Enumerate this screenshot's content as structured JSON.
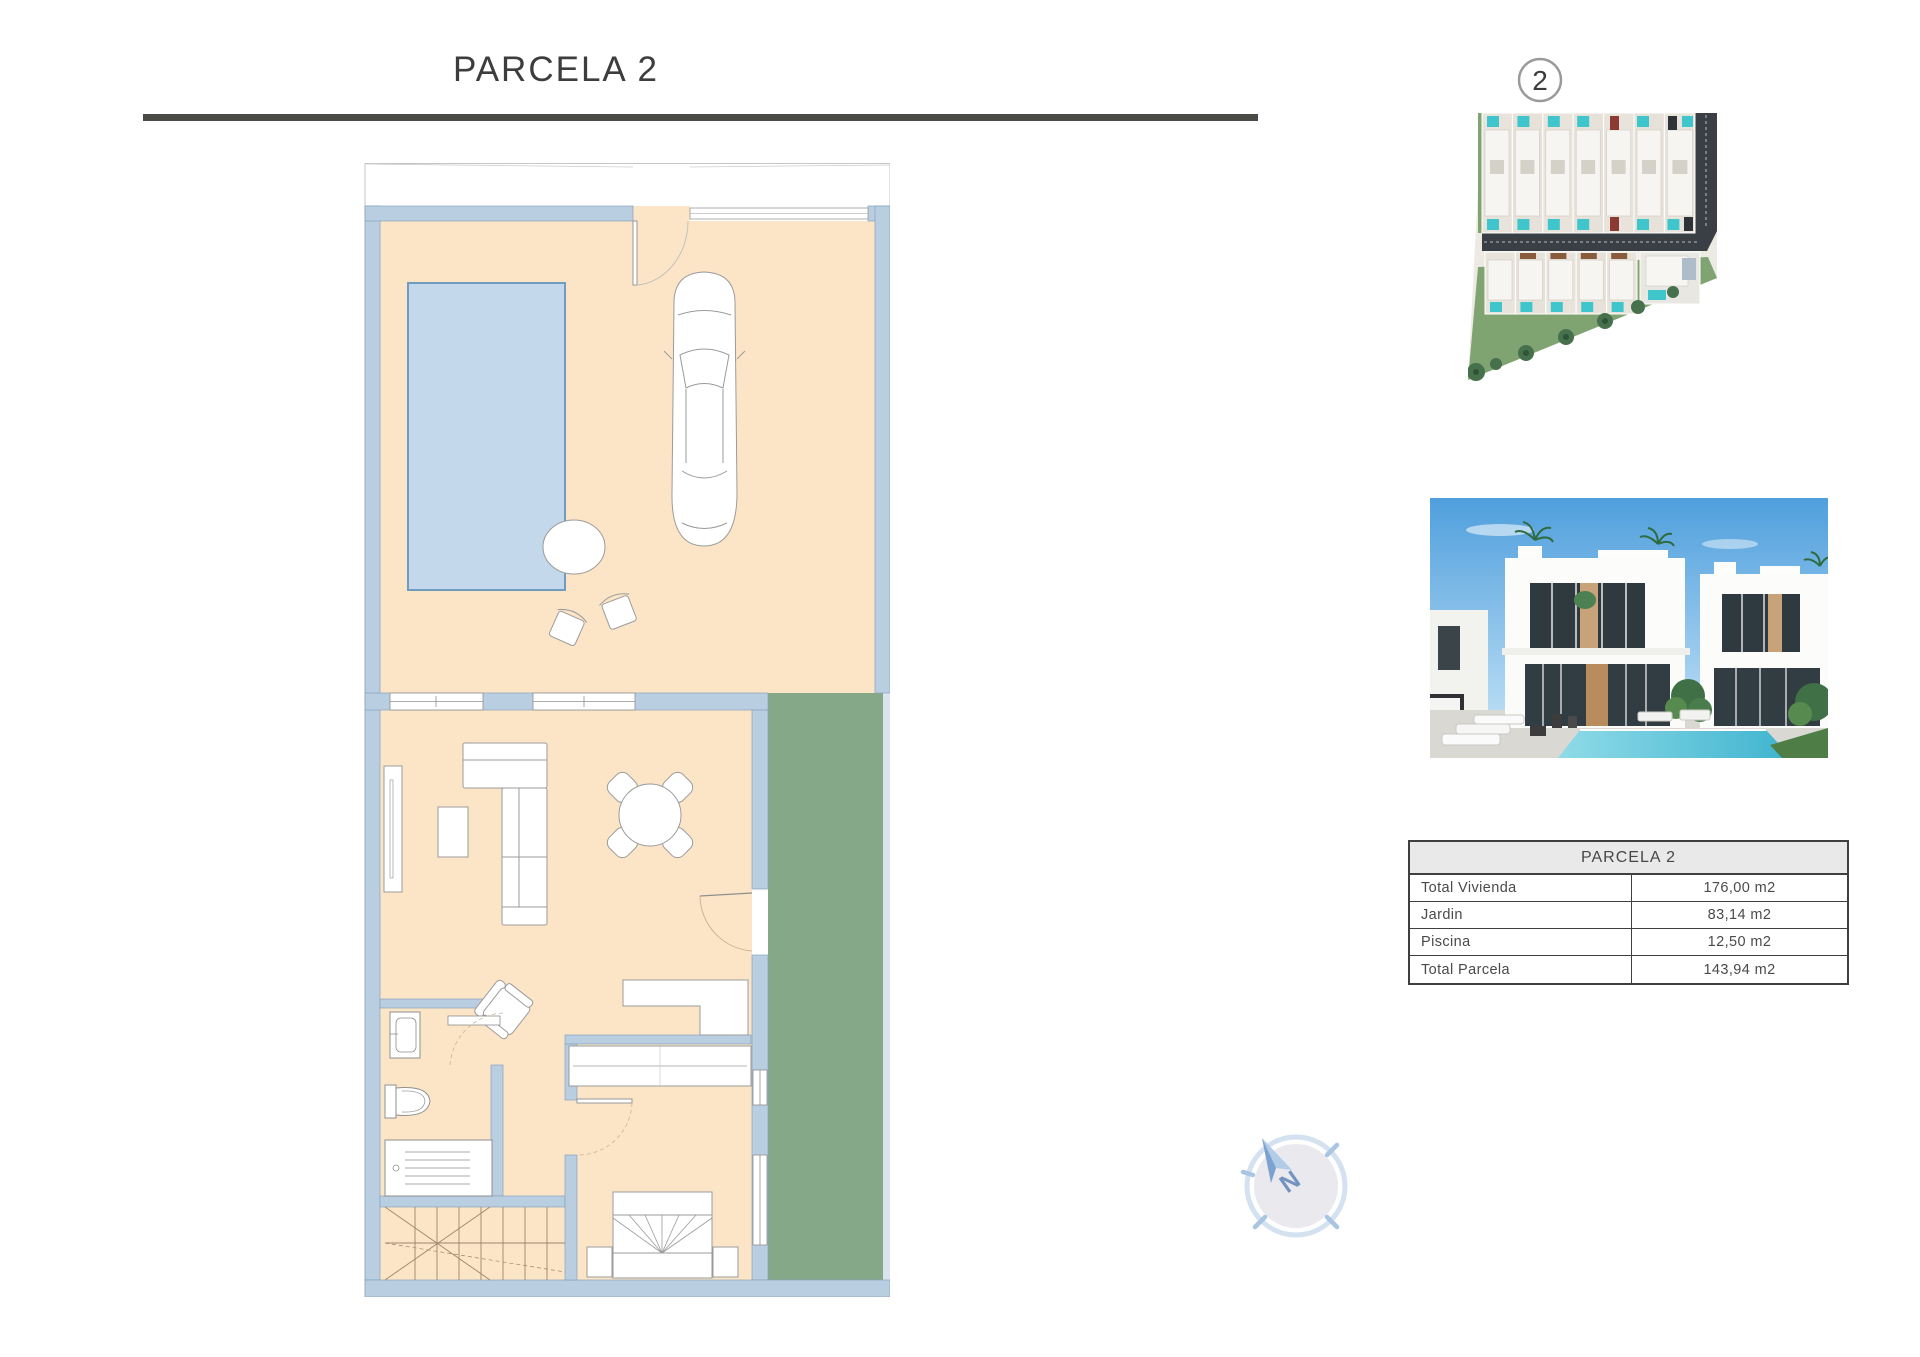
{
  "page": {
    "title": "PARCELA 2"
  },
  "site_plan": {
    "badge": "2"
  },
  "summary_table": {
    "header": "PARCELA 2",
    "rows": [
      {
        "label": "Total Vivienda",
        "value": "176,00 m2"
      },
      {
        "label": "Jardin",
        "value": "83,14 m2"
      },
      {
        "label": "Piscina",
        "value": "12,50 m2"
      },
      {
        "label": "Total Parcela",
        "value": "143,94 m2"
      }
    ]
  },
  "compass": {
    "north_label": "N"
  },
  "colors": {
    "title_text": "#3d3d3d",
    "rule": "#4a4a47",
    "wall": "#b9cee1",
    "floor": "#fce5c7",
    "pool_fill": "#c3d8ea",
    "pool_border": "#6f9dc0",
    "garden": "#85a888",
    "table_border": "#3f3f3f",
    "table_header_bg": "#e9e9e9",
    "road": "#3a3f45",
    "site_pool_teal": "#3fc6cd",
    "lawn": "#7fa471",
    "sky": "#4f9fdd",
    "compass_arrow": "#7ba3d0",
    "compass_ring": "#d3e1f0"
  }
}
